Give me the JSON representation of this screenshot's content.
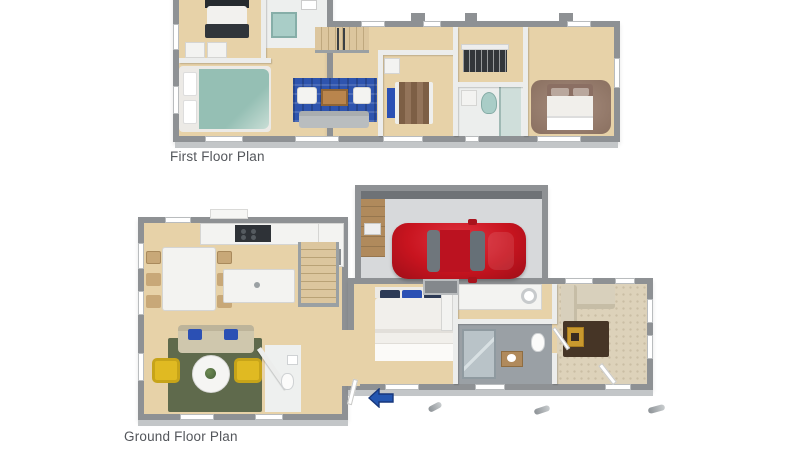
{
  "page": {
    "background": "#ffffff"
  },
  "plans": {
    "first_floor": {
      "label": "First Floor Plan"
    },
    "ground_floor": {
      "label": "Ground Floor Plan"
    }
  },
  "entry_arrow": {
    "symbol": "left-arrow",
    "color": "#2456b0"
  },
  "palette": {
    "wall": "#8e9194",
    "iwall": "#ecedec",
    "wood": "#e7d2a8",
    "wood-light": "#efdfbe",
    "garage-floor": "#d7d9db",
    "car-red": "#c8141f",
    "rug-blue": "#2e54ae",
    "rug-olive": "#5f6a4c",
    "rug-brown": "#463526",
    "carpet": "#ddd2ba",
    "teal": "#95bfb4",
    "sofa-gray": "#b9bdbf",
    "sofa-tan": "#cfc7ad",
    "sofa-beige": "#d8d0bc",
    "yellow": "#e0ba22",
    "pillow-blue": "#2b50b4",
    "white-furn": "#f3f3f1",
    "tile": "#9aa0a5",
    "gold": "#c9992e",
    "mauve": "#8b6f63",
    "wood-furn": "#c8a878",
    "label": "#53565b",
    "skirt": "#c3c6c8",
    "arrow": "#2456b0"
  }
}
